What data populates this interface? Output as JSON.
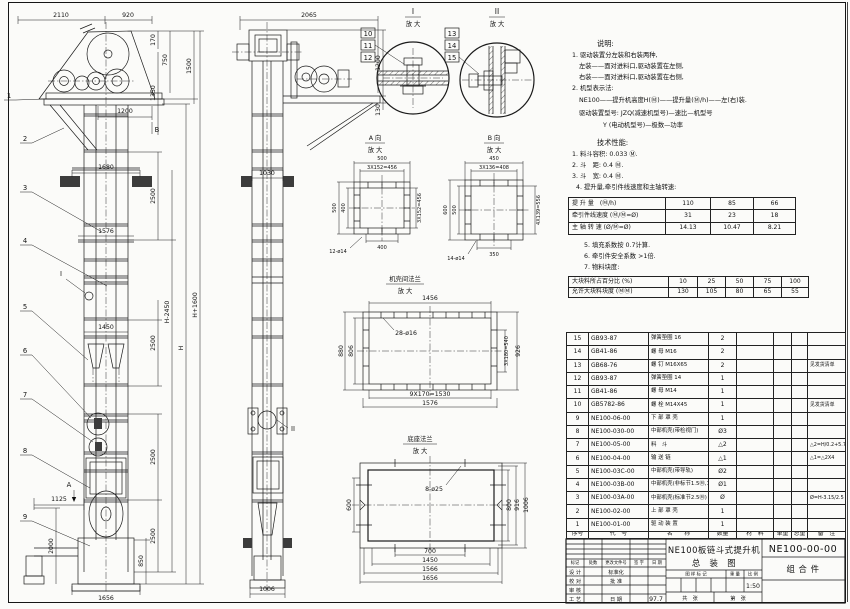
{
  "notes": {
    "title": "说明:",
    "lines": [
      "1. 驱动装置分左装和右装两种,",
      "左装——面对进料口,驱动装置在左侧,",
      "右装——面对进料口,驱动装置在右侧,",
      "2. 机型表示法:",
      "NE100——提升机高度H(Ⓜ)——提升量(Ⓜ/h)——左(右)装.",
      "驱动装置型号: JZQ(减速机型号)—速比—机型号",
      "Y (电动机型号)—极数—功率"
    ]
  },
  "tech": {
    "title": "技术性能:",
    "lines": [
      "1. 料斗容积: 0.033 Ⓜ.",
      "2. 斗　距: 0.4 Ⓜ.",
      "3. 斗　宽: 0.4 Ⓜ.",
      "4. 提升量,牵引件线速度和主轴转速:"
    ],
    "lines2": [
      "5. 填充系数按 0.7计算.",
      "6. 牵引件安全系数 >1倍.",
      "7. 物料块度:"
    ]
  },
  "perf_table": {
    "rows": [
      [
        "提 升 量　(Ⓜ/h)",
        "110",
        "85",
        "66"
      ],
      [
        "牵引件线速度 (Ⓜ/Ⓜ=Ø)",
        "31",
        "23",
        "18"
      ],
      [
        "主 轴 转 速 (Ø/Ⓜ=Ø)",
        "14.13",
        "10.47",
        "8.21"
      ]
    ]
  },
  "lump_table": {
    "rows": [
      [
        "大块料所占百分比 (%)",
        "10",
        "25",
        "50",
        "75",
        "100"
      ],
      [
        "允许大块料块度 (ⓂⓂ)",
        "130",
        "105",
        "80",
        "65",
        "55"
      ]
    ]
  },
  "bom": {
    "headers": [
      "序号",
      "代　号",
      "名　　称",
      "数量",
      "材　料",
      "单重",
      "总重",
      "备　注"
    ],
    "rows": [
      [
        "15",
        "GB93-87",
        "弹簧垫圈  16",
        "2",
        "",
        "",
        "",
        ""
      ],
      [
        "14",
        "GB41-86",
        "螺 母  M16",
        "2",
        "",
        "",
        "",
        ""
      ],
      [
        "13",
        "GB68-76",
        "螺 钉  M16X65",
        "2",
        "",
        "",
        "",
        "见发货清单"
      ],
      [
        "12",
        "GB93-87",
        "弹簧垫圈  14",
        "1",
        "",
        "",
        "",
        ""
      ],
      [
        "11",
        "GB41-86",
        "螺 母  M14",
        "1",
        "",
        "",
        "",
        ""
      ],
      [
        "10",
        "GB5782-86",
        "螺 栓  M14X45",
        "1",
        "",
        "",
        "",
        "见发货清单"
      ],
      [
        "9",
        "NE100-06-00",
        "下 部 罩 壳",
        "1",
        "",
        "",
        "",
        ""
      ],
      [
        "8",
        "NE100-030-00",
        "中部机壳(带检视门)",
        "Ø3",
        "",
        "",
        "",
        ""
      ],
      [
        "7",
        "NE100-05-00",
        "料　斗",
        "△2",
        "",
        "",
        "",
        "△2=H/0.2+5.75"
      ],
      [
        "6",
        "NE100-04-00",
        "输 送 链",
        "△1",
        "",
        "",
        "",
        "△1=△2X4"
      ],
      [
        "5",
        "NE100-03C-00",
        "中部机壳(带导轨)",
        "Ø2",
        "",
        "",
        "",
        ""
      ],
      [
        "4",
        "NE100-03B-00",
        "中部机壳(非标节1.5Ⓜ,1Ⓜ)",
        "Ø1",
        "",
        "",
        "",
        ""
      ],
      [
        "3",
        "NE100-03A-00",
        "中部机壳(标准节2.5Ⓜ)",
        "Ø",
        "",
        "",
        "",
        "Ø=H-3.15/2.5"
      ],
      [
        "2",
        "NE100-02-00",
        "上 部 罩 壳",
        "1",
        "",
        "",
        "",
        ""
      ],
      [
        "1",
        "NE100-01-00",
        "驱 动 装 置",
        "1",
        "",
        "",
        "",
        ""
      ]
    ]
  },
  "title_block": {
    "rev_cols": [
      "标记",
      "处数",
      "更改文件号",
      "签 字",
      "日 期"
    ],
    "roles": [
      "设 计",
      "校 对",
      "审 核",
      "工 艺"
    ],
    "roles2": [
      "标准化",
      "批 准",
      "",
      "日 期"
    ],
    "date_value": "97.7",
    "stamp_label": "图 样 标 记",
    "weight_label": "重 量",
    "scale_label": "比 例",
    "scale_value": "1:50",
    "total_label": "共　张",
    "page_label": "第　张",
    "title_line1": "NE100板链斗式提升机",
    "title_line2": "总　装　图",
    "drawing_no": "NE100-00-00",
    "part_type": "组 合 件"
  },
  "front": {
    "dims": [
      "2110",
      "920",
      "170",
      "750",
      "1350",
      "1500",
      "1200",
      "1680",
      "2500",
      "1576",
      "H-2450",
      "H",
      "H+1600",
      "1450",
      "2500",
      "2500",
      "2500",
      "1125",
      "2000",
      "850",
      "1656"
    ],
    "balloons": [
      "1",
      "2",
      "3",
      "4",
      "5",
      "6",
      "7",
      "8",
      "9"
    ],
    "markers": {
      "b": "B",
      "i": "I",
      "a": "A"
    }
  },
  "side": {
    "dims": [
      "2065",
      "1200",
      "130",
      "1030",
      "1006"
    ],
    "balloons": [
      "10",
      "11",
      "12"
    ],
    "marker_ii": "II"
  },
  "detail_i": {
    "label": "I",
    "mag": "放 大"
  },
  "detail_ii": {
    "label": "II",
    "mag": "放 大",
    "balloons": [
      "13",
      "14",
      "15"
    ]
  },
  "view_a": {
    "label": "A 向",
    "mag": "放 大",
    "dims": [
      "500",
      "3X152=456",
      "500",
      "400",
      "3X152=456",
      "400",
      "12-ø14"
    ]
  },
  "view_b": {
    "label": "B 向",
    "mag": "放 大",
    "dims": [
      "450",
      "3X136=408",
      "600",
      "500",
      "4X139=556",
      "350",
      "14-ø14"
    ]
  },
  "flange": {
    "label": "机壳间法兰",
    "mag": "放 大",
    "dims": [
      "1456",
      "880",
      "806",
      "28-ø16",
      "3X180=540",
      "926",
      "9X170=1530",
      "1576"
    ]
  },
  "base": {
    "label": "底座法兰",
    "mag": "放 大",
    "dims": [
      "600",
      "8-ø25",
      "800",
      "916",
      "1006",
      "700",
      "1450",
      "1566",
      "1656"
    ]
  }
}
